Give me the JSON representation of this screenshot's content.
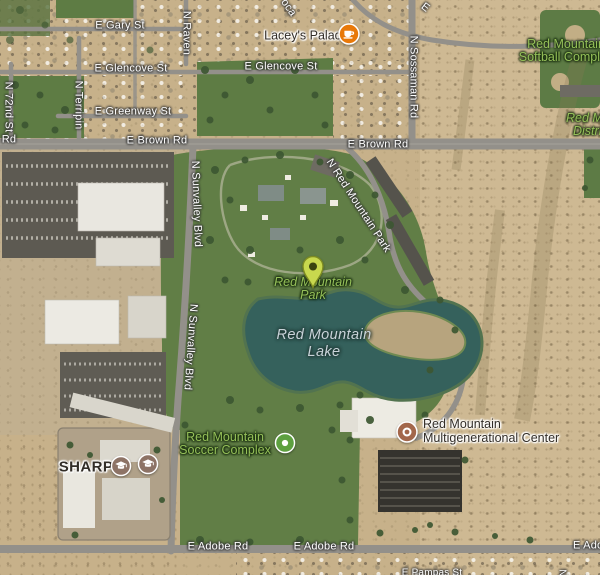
{
  "labels": {
    "roads": {
      "gary": "E Gary St",
      "glencove_w": "E Glencove St",
      "glencove_e": "E Glencove St",
      "greenway": "E Greenway St",
      "brown_w": "E Brown Rd",
      "brown_e": "E Brown Rd",
      "brown_fragment": "Rd",
      "adobe_w": "E Adobe Rd",
      "adobe_mid": "E Adobe Rd",
      "adobe_fragment": "E Adobe Rd",
      "raven": "N Raven",
      "terripin": "N Terripin",
      "seventy_second": "N 72nd St",
      "sossaman": "N Sossaman Rd",
      "sunvalley_n": "N Sunvalley Blvd",
      "sunvalley_s": "N Sunvalley Blvd",
      "red_mountain_park_rd": "N Red Mountain Park",
      "top_fragment_e": "E",
      "top_fragment_oca": "oca",
      "bottom_fragment_street": "E Pampas St",
      "bottom_fragment_n": "N"
    },
    "pois": {
      "laceys_palace": "Lacey's Palace",
      "sharp": "SHARP",
      "multigen_line1": "Red Mountain",
      "multigen_line2": "Multigenerational Center"
    },
    "parks": {
      "softball_line1": "Red Mountain",
      "softball_line2": "Softball Complex",
      "district_line1": "Red Mountain",
      "district_line2": "District",
      "park_line1": "Red Mountain",
      "park_line2": "Park",
      "soccer_line1": "Red Mountain",
      "soccer_line2": "Soccer Complex"
    },
    "water": {
      "lake_line1": "Red Mountain",
      "lake_line2": "Lake"
    }
  },
  "icons": {
    "cafe": {
      "name": "cafe-icon",
      "bg": "#e8790a"
    },
    "school": {
      "name": "school-icon",
      "bg": "#8d7366"
    },
    "park_dot": {
      "name": "park-icon",
      "bg": "#5da03f"
    },
    "generic_poi": {
      "name": "poi-icon",
      "bg": "#a3674b"
    },
    "pin": {
      "name": "map-pin",
      "fill": "#c8d84e"
    }
  },
  "colors": {
    "road_label": "#ffffff",
    "park_label": "#95c059",
    "water_label": "#c9d3d9",
    "poi_label": "#322d27",
    "lake": "#35615c",
    "grass": "#617e46",
    "desert": "#c7b18a",
    "road": "#93908a"
  }
}
